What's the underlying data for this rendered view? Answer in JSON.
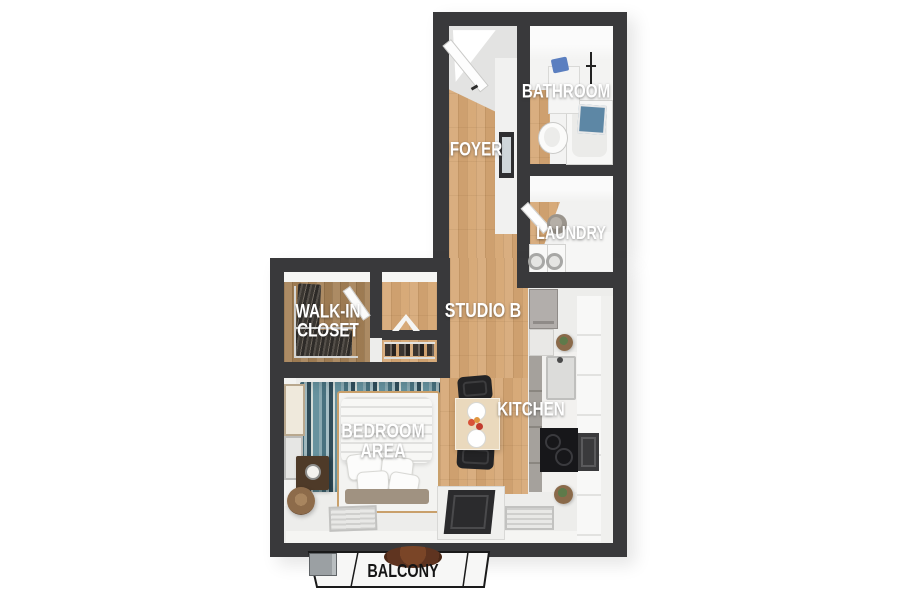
{
  "rooms": {
    "foyer": "FOYER",
    "bathroom": "BATHROOM",
    "laundry": "LAUNDRY",
    "walk_in_closet": "WALK-IN\nCLOSET",
    "studio": "STUDIO B",
    "kitchen": "KITCHEN",
    "bedroom_area": "BEDROOM\nAREA",
    "balcony": "BALCONY"
  },
  "colors": {
    "wall": "#39393b",
    "wood_floor": "#d6a876",
    "closet_wood": "#a8855c",
    "white_floor": "#ededeb",
    "rug_teal": "#49727f",
    "towel_blue": "#5b7fc0",
    "label_text": "#ffffff",
    "balcony_label_text": "#151515"
  },
  "fixtures": [
    "entry-door",
    "bed",
    "area-rug",
    "nightstand",
    "table-lamp",
    "laundry-basket",
    "picture-frame",
    "floor-vent",
    "balcony-sliding-door",
    "dining-table",
    "dining-chair",
    "kitchen-sink",
    "cooktop",
    "oven",
    "refrigerator-cabinet",
    "toilet",
    "bathtub",
    "vanity-sink",
    "towel-bar",
    "washer",
    "dryer",
    "clothes-rack",
    "shoe-rack",
    "valet-stand",
    "balcony-chair",
    "ac-unit"
  ]
}
